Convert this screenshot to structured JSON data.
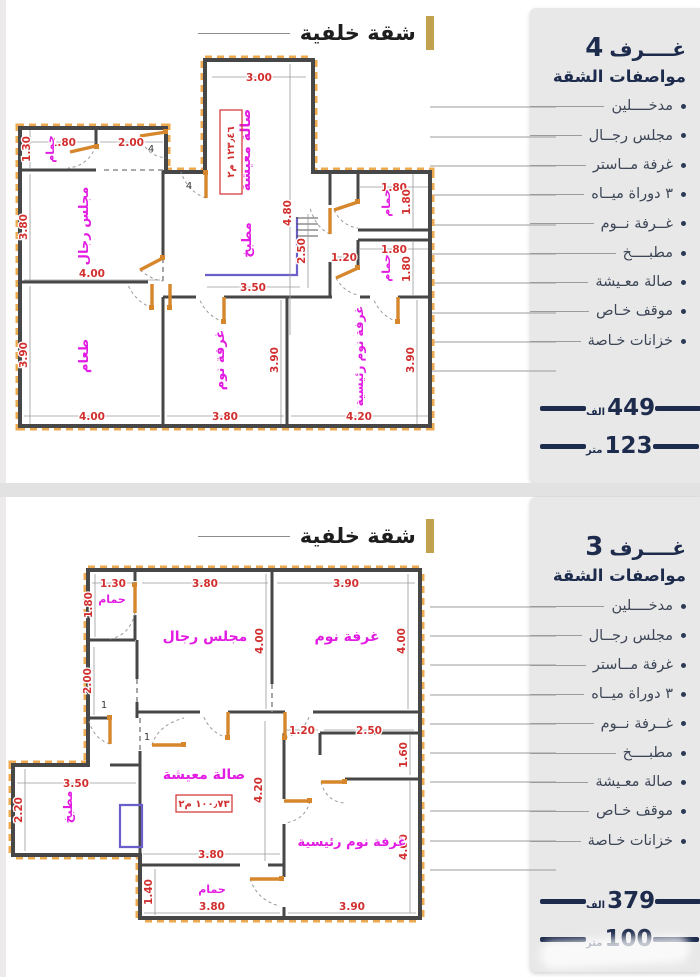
{
  "sections": [
    {
      "title": "شقة خلفية",
      "panel": {
        "rooms_count": "4",
        "rooms_word": "غــــرف",
        "specs_title": "مواصفات الشقة",
        "specs": [
          "مدخــــلين",
          "مجلس رجــال",
          "غرفة مــاستر",
          "٣ دوراة ميــاه",
          "غــرفة نــوم",
          "مطبــــخ",
          "صالة معـيشة",
          "موقف خـاص",
          "خزانات خـاصة"
        ],
        "price_value": "449",
        "price_unit": "الف",
        "size_value": "123",
        "size_unit": "متر"
      },
      "plan": {
        "area_box": "١٢٣٫٤٦ م٢",
        "door_tag": "4",
        "rooms": [
          "صالة معيشة",
          "حمام",
          "مجلس رجال",
          "مطبخ",
          "حمام",
          "حمام",
          "طعام",
          "غرفة نوم",
          "غرفة نوم رئيسية"
        ],
        "dims": [
          "3.00",
          "4.80",
          "1.80",
          "2.00",
          "1.30",
          "3.80",
          "4.00",
          "3.90",
          "4.00",
          "3.80",
          "3.90",
          "4.20",
          "3.90",
          "3.50",
          "2.50",
          "1.20",
          "1.80",
          "1.80",
          "1.80",
          "1.80"
        ]
      }
    },
    {
      "title": "شقة خلفية",
      "panel": {
        "rooms_count": "3",
        "rooms_word": "غــــرف",
        "specs_title": "مواصفات الشقة",
        "specs": [
          "مدخــــلين",
          "مجلس رجــال",
          "غرفة مــاستر",
          "٣ دوراة ميــاه",
          "غــرفة نــوم",
          "مطبــــخ",
          "صالة معـيشة",
          "موقف خـاص",
          "خزانات خـاصة"
        ],
        "price_value": "379",
        "price_unit": "الف",
        "size_value": "100",
        "size_unit": "متر"
      },
      "plan": {
        "area_box": "١٠٠٫٧٣ م٢",
        "door_tag": "1",
        "rooms": [
          "حمام",
          "مجلس رجال",
          "غرفة نوم",
          "مطبخ",
          "صالة معيشة",
          "غرفة نوم رئيسية",
          "حمام"
        ],
        "dims": [
          "1.30",
          "1.80",
          "3.80",
          "3.90",
          "4.00",
          "4.00",
          "2.00",
          "1.20",
          "2.50",
          "1.60",
          "4.20",
          "3.50",
          "2.20",
          "3.80",
          "1.40",
          "3.80",
          "3.90",
          "4.00"
        ]
      }
    }
  ]
}
